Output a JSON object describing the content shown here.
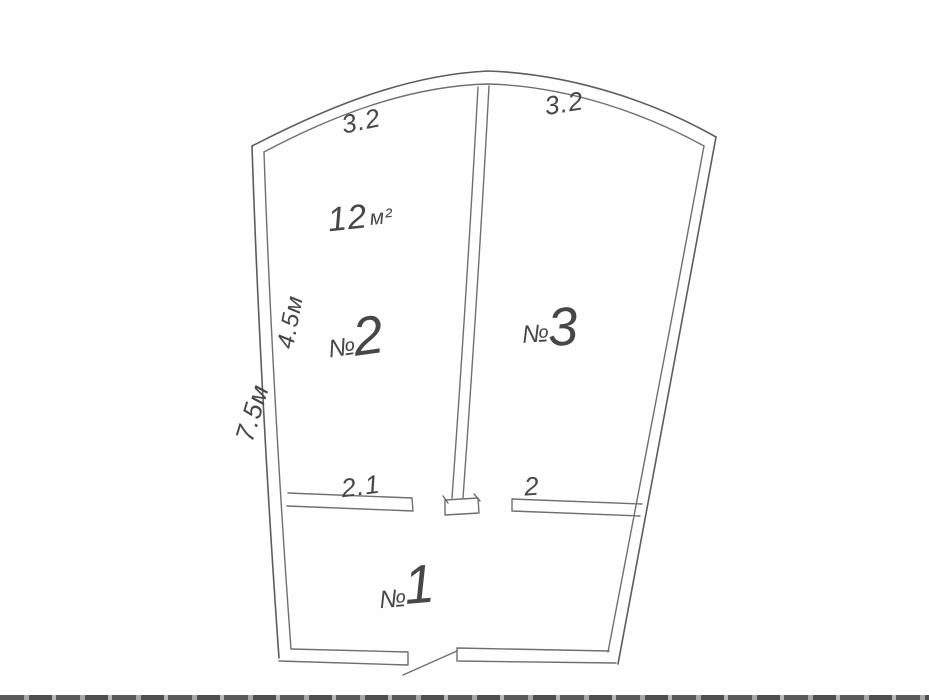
{
  "document": {
    "type": "hand-drawn floor plan sketch (pencil on white paper, scanned)",
    "background_color": "#fefefe",
    "pencil_color": "#6f6f6f",
    "handwriting_color": "#474747"
  },
  "rooms": [
    {
      "prefix": "№",
      "number": "1"
    },
    {
      "prefix": "№",
      "number": "2"
    },
    {
      "prefix": "№",
      "number": "3"
    }
  ],
  "area": {
    "value": "12",
    "unit": "м²",
    "belongs_to_room": "2"
  },
  "dimensions": {
    "top_left_wall": "3.2",
    "top_right_wall": "3.2",
    "left_wall_upper": "4.5м",
    "left_wall_total": "7.5м",
    "mid_wall_left": "2.1",
    "mid_wall_right": "2"
  }
}
